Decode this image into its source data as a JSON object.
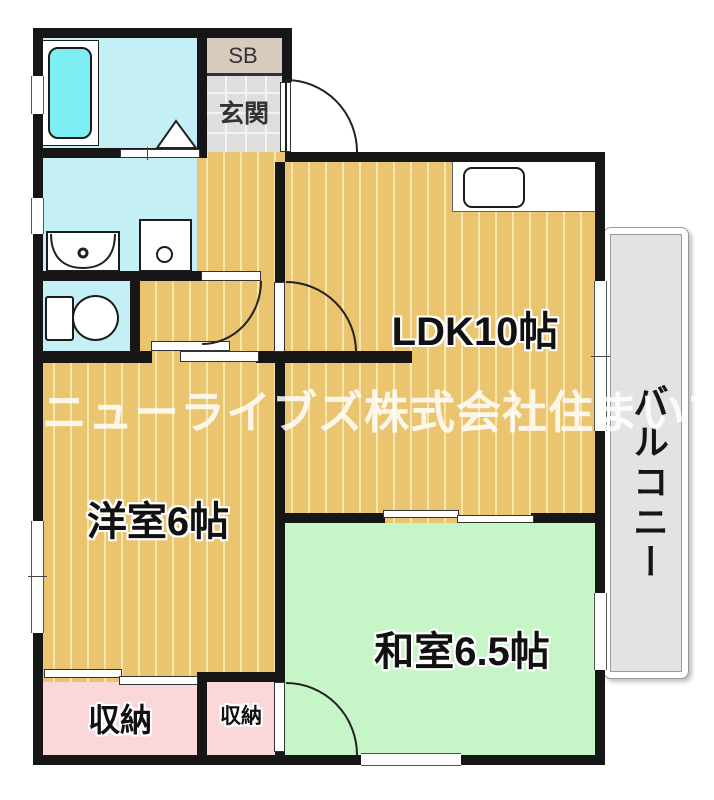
{
  "rooms": {
    "ldk": {
      "label": "LDK10帖"
    },
    "western": {
      "label": "洋室6帖"
    },
    "japanese": {
      "label": "和室6.5帖"
    },
    "entrance": {
      "label": "玄関"
    },
    "shoebox": {
      "label": "SB"
    },
    "balcony": {
      "label": "バルコニー"
    },
    "closet_large": {
      "label": "収納"
    },
    "closet_small": {
      "label": "収納"
    }
  },
  "watermark": {
    "text": "ニューライブズ株式会社住まいプロ"
  },
  "colors": {
    "wall": "#161616",
    "flooring": "#eac46e",
    "flooring-stripe": "#f6e5ac",
    "tatami": "#c6f6c8",
    "closet": "#fad8da",
    "bath": "#c4eff5",
    "tub": "#7deff2",
    "tile": "#dedede",
    "shoebox": "#d8cabd",
    "balcony": "#e3e3e3",
    "wm": "rgba(255,255,255,0.85)"
  }
}
